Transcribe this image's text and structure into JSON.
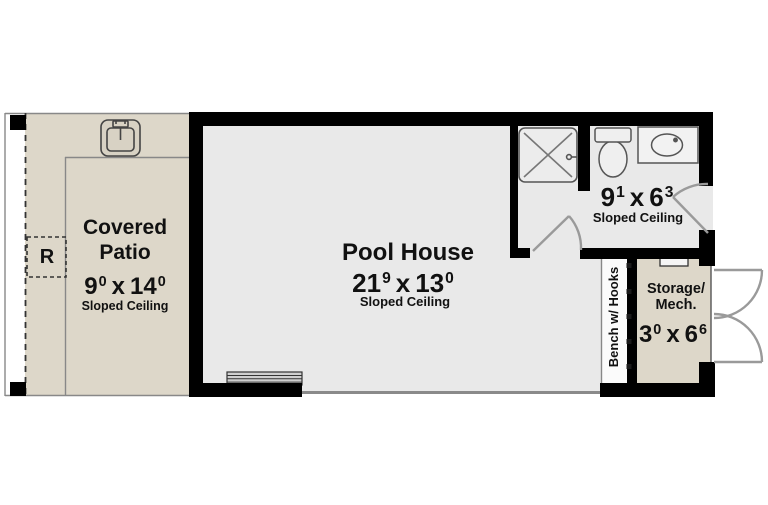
{
  "plan": {
    "covered_patio": {
      "title_line1": "Covered",
      "title_line2": "Patio",
      "dim": {
        "w": "9",
        "w_sup": "0",
        "sep": "x",
        "h": "14",
        "h_sup": "0"
      },
      "ceiling": "Sloped Ceiling",
      "refrigerator_label": "R"
    },
    "pool_house": {
      "title": "Pool House",
      "dim": {
        "w": "21",
        "w_sup": "9",
        "sep": "x",
        "h": "13",
        "h_sup": "0"
      },
      "ceiling": "Sloped Ceiling"
    },
    "bathroom": {
      "dim": {
        "w": "9",
        "w_sup": "1",
        "sep": "x",
        "h": "6",
        "h_sup": "3"
      },
      "ceiling": "Sloped Ceiling"
    },
    "storage": {
      "title_line1": "Storage/",
      "title_line2": "Mech.",
      "dim": {
        "w": "3",
        "w_sup": "0",
        "sep": "x",
        "h": "6",
        "h_sup": "6"
      }
    },
    "bench": {
      "label": "Bench w/ Hooks"
    }
  },
  "icons": {
    "sink": "patio-sink-icon",
    "shower": "shower-icon",
    "toilet": "toilet-icon",
    "vanity": "vanity-sink-icon",
    "hooks": "wall-hook-icon",
    "steps": "steps-icon",
    "doors": "door-swing-icon"
  },
  "colors": {
    "patio_fill": "#ddd7c9",
    "storage_fill": "#ddd7c9",
    "interior_fill": "#e9e9e9",
    "wall": "#000000",
    "door_swing": "#9a9a9a"
  }
}
